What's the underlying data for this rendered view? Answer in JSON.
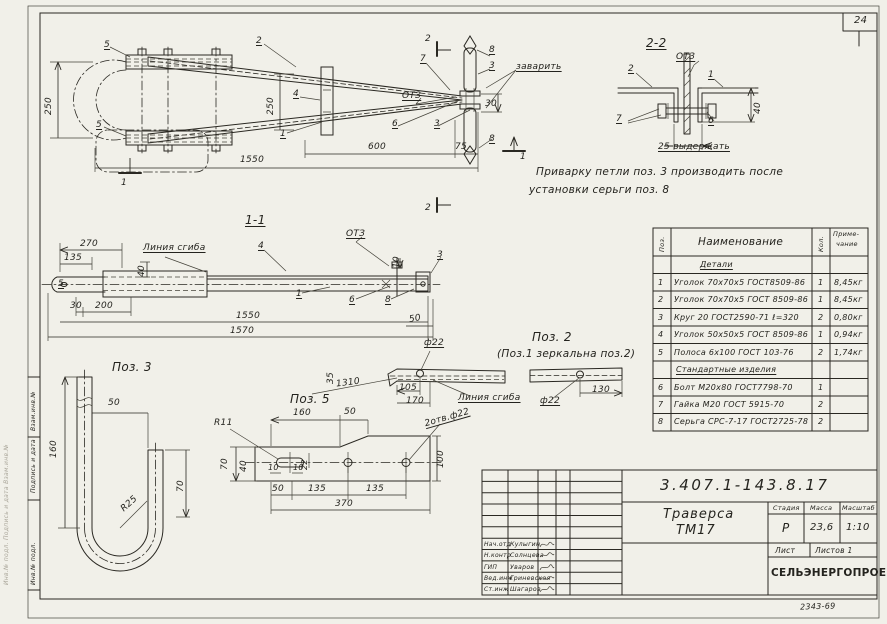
{
  "page": {
    "sheet_number": "24",
    "archive_number": "2343-69"
  },
  "margin_stamp": {
    "cell_top": "Взам.инв.№",
    "cell_mid": "Подпись и дата",
    "cell_bottom": "Инв.№ подл.",
    "edge_text": "Инв.№ подл.   Подпись и дата   Взам.инв.№"
  },
  "note": {
    "line1": "Приварку  петли  поз. 3  производить  после",
    "line2": "установки  серьги   поз. 8"
  },
  "plan": {
    "callout_5a": "5",
    "callout_5b": "5",
    "callout_2": "2",
    "callout_4": "4",
    "callout_1": "1",
    "callout_7": "7",
    "callout_3a": "3",
    "callout_3b": "3",
    "callout_6": "6",
    "callout_8a": "8",
    "callout_8b": "8",
    "weld_otz": "ОТЗ",
    "weld_note": "заварить",
    "dim_250_left": "250",
    "dim_250_mid": "250",
    "dim_600": "600",
    "dim_75": "75",
    "dim_1550": "1550",
    "dim_30": "30",
    "sec2_top": "2",
    "sec2_bottom": "2",
    "sec1_left": "1",
    "sec1_right": "1"
  },
  "section11": {
    "title": "1-1",
    "dim_270": "270",
    "dim_135": "135",
    "bend_line": "Линия сгиба",
    "weld_otz": "ОТЗ",
    "callout_4": "4",
    "callout_5": "5",
    "callout_1": "1",
    "callout_6": "6",
    "callout_8": "8",
    "callout_3": "3",
    "dim_40": "40",
    "dim_10": "10",
    "dim_30": "30",
    "dim_200": "200",
    "dim_50": "50",
    "dim_1550": "1550",
    "dim_1570": "1570"
  },
  "section22": {
    "title": "2-2",
    "weld_otz": "ОТЗ",
    "callout_2": "2",
    "callout_1": "1",
    "callout_7": "7",
    "callout_6": "6",
    "dim_40": "40",
    "note_25": "25 выдержать"
  },
  "pos2": {
    "title": "Поз. 2",
    "subtitle": "(Поз.1 зеркальна поз.2)",
    "dia22_a": "ф22",
    "dia22_b": "ф22",
    "dim_1310": "1310",
    "dim_35": "35",
    "dim_105": "105",
    "dim_170": "170",
    "dim_130": "130",
    "bend_line": "Линия сгиба"
  },
  "pos3": {
    "title": "Поз. 3",
    "dim_50": "50",
    "dim_160": "160",
    "dim_70": "70",
    "radius": "R25"
  },
  "pos5": {
    "title": "Поз. 5",
    "holes_note": "2отв.ф22",
    "radius": "R11",
    "dim_160": "160",
    "dim_50_top": "50",
    "dim_70": "70",
    "dim_40": "40",
    "dim_10a": "10",
    "dim_10b": "10",
    "dim_22": "22",
    "dim_50_bot": "50",
    "dim_135a": "135",
    "dim_135b": "135",
    "dim_370": "370",
    "dim_100": "100"
  },
  "spec_table": {
    "header": {
      "pos": "Поз.",
      "name": "Наименование",
      "qty": "Кол.",
      "note1": "Приме-",
      "note2": "чание"
    },
    "section_details": "Детали",
    "section_standard": "Стандартные изделия",
    "rows": [
      {
        "pos": "1",
        "name": "Уголок 70х70х5 ГОСТ8509-86",
        "qty": "1",
        "note": "8,45кг"
      },
      {
        "pos": "2",
        "name": "Уголок 70х70х5 ГОСТ 8509-86",
        "qty": "1",
        "note": "8,45кг"
      },
      {
        "pos": "3",
        "name": "Круг 20 ГОСТ2590-71 ℓ=320",
        "qty": "2",
        "note": "0,80кг"
      },
      {
        "pos": "4",
        "name": "Уголок 50х50х5 ГОСТ 8509-86",
        "qty": "1",
        "note": "0,94кг"
      },
      {
        "pos": "5",
        "name": "Полоса 6х100 ГОСТ 103-76",
        "qty": "2",
        "note": "1,74кг"
      },
      {
        "pos": "6",
        "name": "Болт М20х80 ГОСТ7798-70",
        "qty": "1",
        "note": ""
      },
      {
        "pos": "7",
        "name": "Гайка М20 ГОСТ 5915-70",
        "qty": "2",
        "note": ""
      },
      {
        "pos": "8",
        "name": "Серьга СРС-7-17 ГОСТ2725-78",
        "qty": "2",
        "note": ""
      }
    ]
  },
  "title_block": {
    "doc_number": "3.407.1-143.8.17",
    "product_line1": "Траверса",
    "product_line2": "ТМ17",
    "stage_label": "Стадия",
    "mass_label": "Масса",
    "scale_label": "Масштаб",
    "stage": "Р",
    "mass": "23,6",
    "scale": "1:10",
    "sheet_label": "Лист",
    "sheets_label": "Листов 1",
    "org": "СЕЛЬЭНЕРГОПРОЕКТ",
    "sign_rows": [
      {
        "role": "Нач.отд",
        "name": "Кулыгин"
      },
      {
        "role": "Н.контр",
        "name": "Солнцева"
      },
      {
        "role": "ГИП",
        "name": "Уваров"
      },
      {
        "role": "Вед.инж",
        "name": "Гриневская"
      },
      {
        "role": "Ст.инж",
        "name": "Шагаров"
      }
    ]
  }
}
